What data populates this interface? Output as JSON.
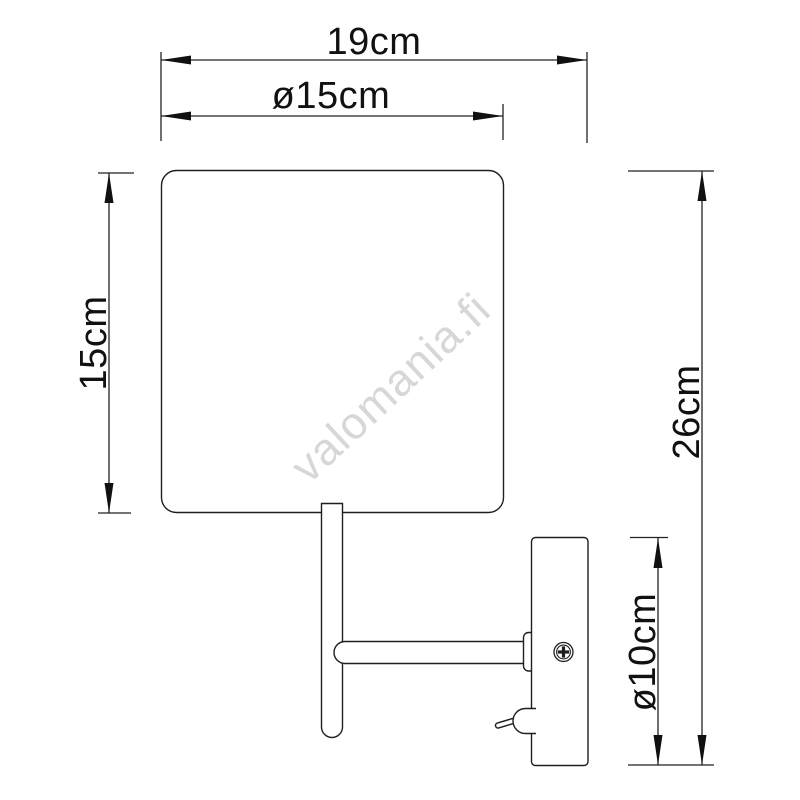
{
  "page": {
    "background": "#ffffff"
  },
  "diagram": {
    "subject": "wall-lamp-dimension-drawing",
    "line_color": "#1f1f1f",
    "text_color": "#111111",
    "dimensions": {
      "overall_width": "19cm",
      "shade_diameter": "ø15cm",
      "shade_height": "15cm",
      "overall_height": "26cm",
      "backplate_diameter": "ø10cm"
    },
    "watermark": {
      "text": "valomania.fi",
      "color": "#d7d7d7"
    }
  }
}
